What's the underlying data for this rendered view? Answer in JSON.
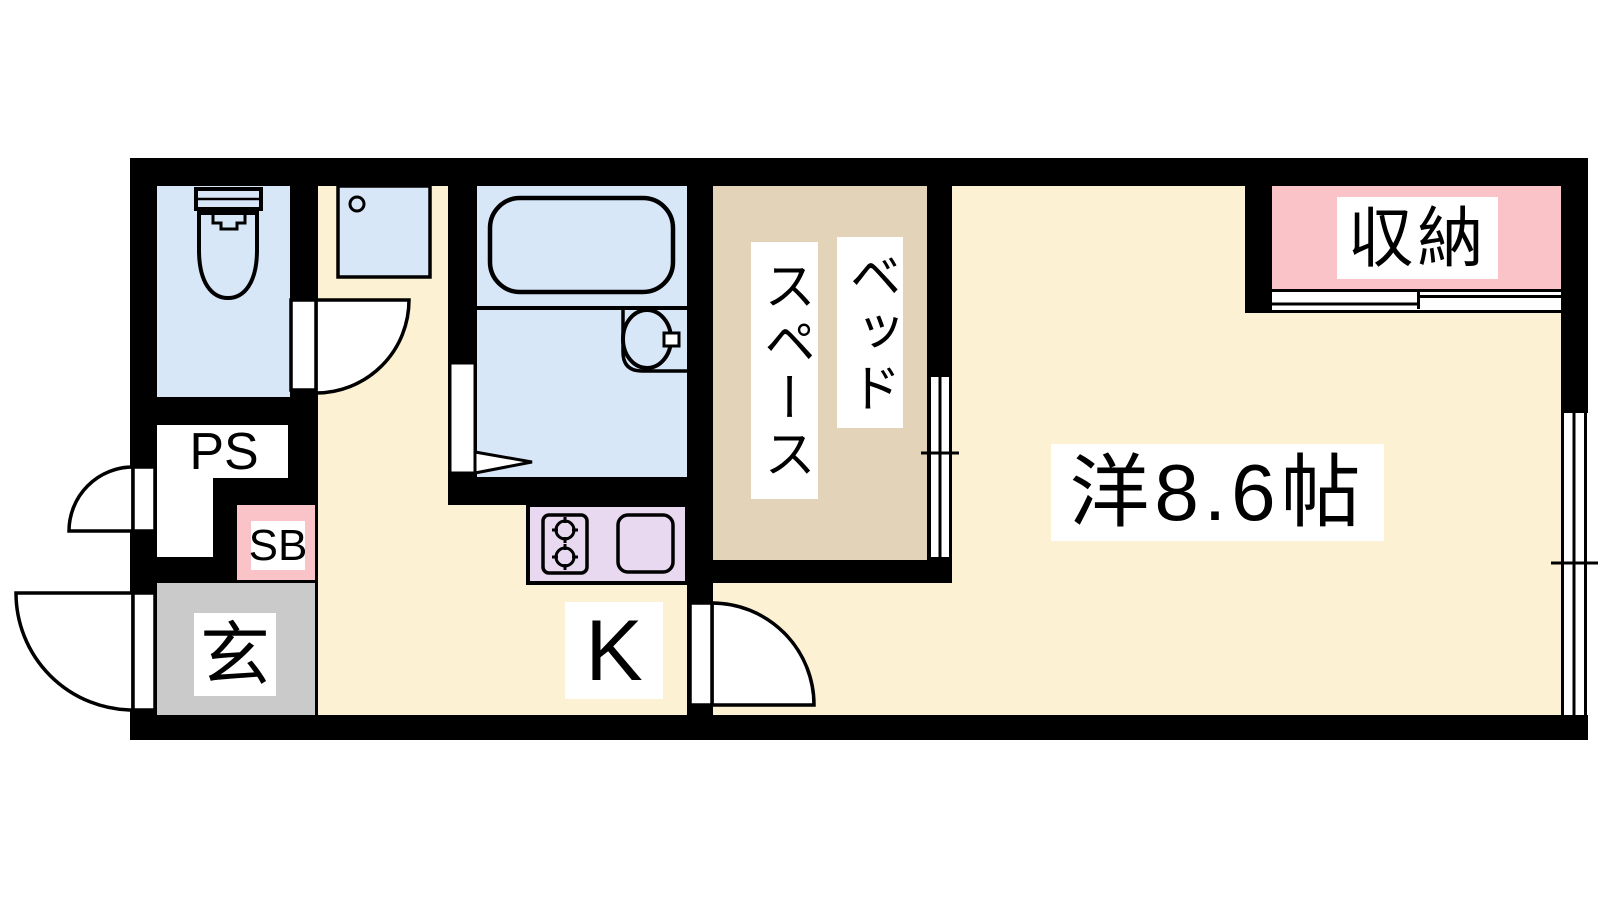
{
  "title": "apartment-floor-plan",
  "colors": {
    "wall": "#000000",
    "water_blue": "#d7e7f8",
    "floor_cream": "#fcf2d3",
    "bed_tan": "#e2d3b9",
    "closet_pink": "#f9c3c8",
    "stove_lavender": "#e8d9f1",
    "genkan_gray": "#cacaca",
    "door_white": "#ffffff"
  },
  "labels": {
    "ps": "PS",
    "sb": "SB",
    "genkan": "玄",
    "kitchen": "K",
    "bed_space_line1": "ベッド",
    "bed_space_line2": "スペース",
    "main_room": "洋8.6帖",
    "closet": "収納"
  },
  "rooms": [
    {
      "id": "toilet",
      "label": ""
    },
    {
      "id": "pipe-space",
      "label": "PS"
    },
    {
      "id": "shoe-box",
      "label": "SB"
    },
    {
      "id": "entrance",
      "label": "玄"
    },
    {
      "id": "kitchen",
      "label": "K"
    },
    {
      "id": "bathroom",
      "label": ""
    },
    {
      "id": "bed-space",
      "label": "ベッドスペース"
    },
    {
      "id": "western-room",
      "label": "洋8.6帖",
      "size_tatami": "8.6"
    },
    {
      "id": "closet",
      "label": "収納"
    }
  ]
}
